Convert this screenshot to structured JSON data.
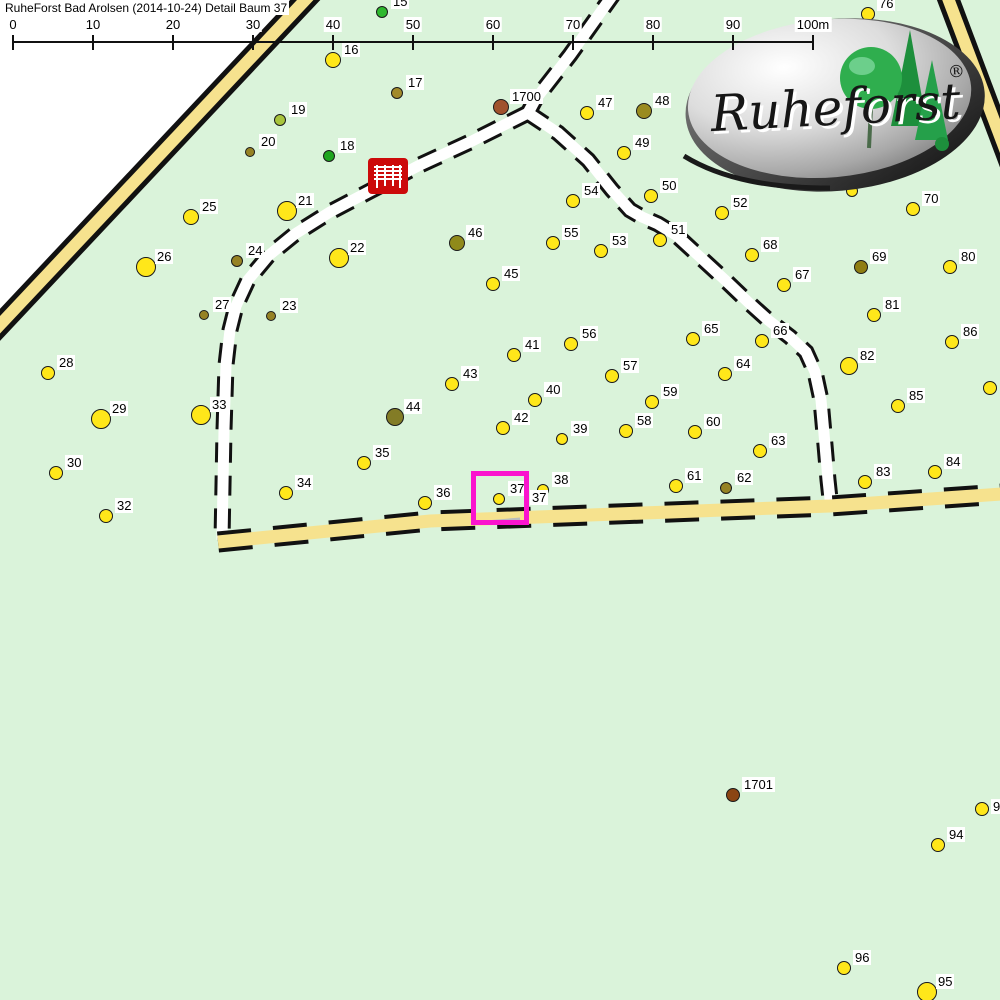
{
  "title": "RuheForst Bad Arolsen (2014-10-24) Detail  Baum 37",
  "logo": {
    "brand": "Ruheforst",
    "registered": "®"
  },
  "scale_bar": {
    "labels": [
      "0",
      "10",
      "20",
      "30",
      "40",
      "50",
      "60",
      "70",
      "80",
      "90",
      "100m"
    ],
    "x_start": 13,
    "x_spacing": 80,
    "line_y": 42,
    "tick_top": 35,
    "tick_bottom": 50
  },
  "map": {
    "background": "#daf3da",
    "outside_fill": "#ffffff",
    "outside_polygon": "0,0 310,0 0,335",
    "road_fill": "#f6e28e",
    "trail_fill": "#ffffff",
    "casing_color": "#111111",
    "highlight_color": "#fa14ce",
    "bench_color": "#cc0a0a",
    "roads": [
      {
        "name": "road-top-left",
        "edge": "solid",
        "pts": "324,-20 -19,345"
      },
      {
        "name": "road-top-right",
        "edge": "solid",
        "pts": "943,-15 1012,168"
      },
      {
        "name": "road-bottom",
        "edge": "dash",
        "pts": "218,542 430,521 830,506 1002,494"
      }
    ],
    "paths": [
      {
        "name": "trail-north",
        "pts": "615,-8 570,55 535,100 528,113"
      },
      {
        "name": "trail-west",
        "pts": "528,113 470,142 420,165 372,190 330,212 295,234 268,256 248,280 236,306 230,330 226,365 224,430 222,540"
      },
      {
        "name": "trail-east",
        "pts": "528,113 558,133 588,160 612,190 630,210 642,217 658,224 676,235 700,257 725,280 748,302 768,320 790,337 806,352 815,372 821,400 825,445 828,480 831,508"
      }
    ],
    "gray_line": {
      "x1": 486,
      "y1": 522,
      "x2": 520,
      "y2": 519,
      "color": "#b9bdbd"
    },
    "highlight_box": {
      "x": 471,
      "y": 471,
      "w": 58,
      "h": 54,
      "border": 5
    },
    "trees": [
      {
        "id": "15",
        "x": 382,
        "y": 12,
        "r": 6,
        "color": "#2eb82e"
      },
      {
        "id": "16",
        "x": 333,
        "y": 60,
        "r": 8,
        "color": "#ffe71a"
      },
      {
        "id": "17",
        "x": 397,
        "y": 93,
        "r": 6,
        "color": "#a28a2a"
      },
      {
        "id": "18",
        "x": 329,
        "y": 156,
        "r": 6,
        "color": "#1fa51f"
      },
      {
        "id": "19",
        "x": 280,
        "y": 120,
        "r": 6,
        "color": "#a8c43c"
      },
      {
        "id": "20",
        "x": 250,
        "y": 152,
        "r": 5,
        "color": "#968224"
      },
      {
        "id": "21",
        "x": 287,
        "y": 211,
        "r": 10,
        "color": "#ffe71a"
      },
      {
        "id": "22",
        "x": 339,
        "y": 258,
        "r": 10,
        "color": "#ffe71a"
      },
      {
        "id": "23",
        "x": 271,
        "y": 316,
        "r": 5,
        "color": "#968224"
      },
      {
        "id": "24",
        "x": 237,
        "y": 261,
        "r": 6,
        "color": "#968224"
      },
      {
        "id": "25",
        "x": 191,
        "y": 217,
        "r": 8,
        "color": "#ffe71a"
      },
      {
        "id": "26",
        "x": 146,
        "y": 267,
        "r": 10,
        "color": "#ffe71a"
      },
      {
        "id": "27",
        "x": 204,
        "y": 315,
        "r": 5,
        "color": "#968224"
      },
      {
        "id": "28",
        "x": 48,
        "y": 373,
        "r": 7,
        "color": "#ffe71a"
      },
      {
        "id": "29",
        "x": 101,
        "y": 419,
        "r": 10,
        "color": "#ffe71a"
      },
      {
        "id": "30",
        "x": 56,
        "y": 473,
        "r": 7,
        "color": "#ffe71a"
      },
      {
        "id": "32",
        "x": 106,
        "y": 516,
        "r": 7,
        "color": "#ffe71a"
      },
      {
        "id": "33",
        "x": 201,
        "y": 415,
        "r": 10,
        "color": "#ffe71a"
      },
      {
        "id": "34",
        "x": 286,
        "y": 493,
        "r": 7,
        "color": "#ffe71a"
      },
      {
        "id": "35",
        "x": 364,
        "y": 463,
        "r": 7,
        "color": "#ffe71a"
      },
      {
        "id": "36",
        "x": 425,
        "y": 503,
        "r": 7,
        "color": "#ffe71a"
      },
      {
        "id": "37",
        "x": 499,
        "y": 499,
        "r": 6,
        "color": "#ffe71a"
      },
      {
        "id": "38",
        "x": 543,
        "y": 490,
        "r": 6,
        "color": "#ffe71a"
      },
      {
        "id": "39",
        "x": 562,
        "y": 439,
        "r": 6,
        "color": "#ffe71a"
      },
      {
        "id": "40",
        "x": 535,
        "y": 400,
        "r": 7,
        "color": "#ffe71a"
      },
      {
        "id": "41",
        "x": 514,
        "y": 355,
        "r": 7,
        "color": "#ffe71a"
      },
      {
        "id": "42",
        "x": 503,
        "y": 428,
        "r": 7,
        "color": "#ffe71a"
      },
      {
        "id": "43",
        "x": 452,
        "y": 384,
        "r": 7,
        "color": "#ffe71a"
      },
      {
        "id": "44",
        "x": 395,
        "y": 417,
        "r": 9,
        "color": "#837c26"
      },
      {
        "id": "45",
        "x": 493,
        "y": 284,
        "r": 7,
        "color": "#ffe71a"
      },
      {
        "id": "46",
        "x": 457,
        "y": 243,
        "r": 8,
        "color": "#8f8a1a"
      },
      {
        "id": "47",
        "x": 587,
        "y": 113,
        "r": 7,
        "color": "#ffe71a"
      },
      {
        "id": "48",
        "x": 644,
        "y": 111,
        "r": 8,
        "color": "#9a8b1f"
      },
      {
        "id": "49",
        "x": 624,
        "y": 153,
        "r": 7,
        "color": "#ffe71a"
      },
      {
        "id": "50",
        "x": 651,
        "y": 196,
        "r": 7,
        "color": "#ffe71a"
      },
      {
        "id": "51",
        "x": 660,
        "y": 240,
        "r": 7,
        "color": "#ffe71a"
      },
      {
        "id": "52",
        "x": 722,
        "y": 213,
        "r": 7,
        "color": "#ffe71a"
      },
      {
        "id": "53",
        "x": 601,
        "y": 251,
        "r": 7,
        "color": "#ffe71a"
      },
      {
        "id": "54",
        "x": 573,
        "y": 201,
        "r": 7,
        "color": "#ffe71a"
      },
      {
        "id": "55",
        "x": 553,
        "y": 243,
        "r": 7,
        "color": "#ffe71a"
      },
      {
        "id": "56",
        "x": 571,
        "y": 344,
        "r": 7,
        "color": "#ffe71a"
      },
      {
        "id": "57",
        "x": 612,
        "y": 376,
        "r": 7,
        "color": "#ffe71a"
      },
      {
        "id": "58",
        "x": 626,
        "y": 431,
        "r": 7,
        "color": "#ffe71a"
      },
      {
        "id": "59",
        "x": 652,
        "y": 402,
        "r": 7,
        "color": "#ffe71a"
      },
      {
        "id": "60",
        "x": 695,
        "y": 432,
        "r": 7,
        "color": "#ffe71a"
      },
      {
        "id": "61",
        "x": 676,
        "y": 486,
        "r": 7,
        "color": "#ffe71a"
      },
      {
        "id": "62",
        "x": 726,
        "y": 488,
        "r": 6,
        "color": "#968224"
      },
      {
        "id": "63",
        "x": 760,
        "y": 451,
        "r": 7,
        "color": "#ffe71a"
      },
      {
        "id": "64",
        "x": 725,
        "y": 374,
        "r": 7,
        "color": "#ffe71a"
      },
      {
        "id": "65",
        "x": 693,
        "y": 339,
        "r": 7,
        "color": "#ffe71a"
      },
      {
        "id": "66",
        "x": 762,
        "y": 341,
        "r": 7,
        "color": "#ffe71a"
      },
      {
        "id": "67",
        "x": 784,
        "y": 285,
        "r": 7,
        "color": "#ffe71a"
      },
      {
        "id": "68",
        "x": 752,
        "y": 255,
        "r": 7,
        "color": "#ffe71a"
      },
      {
        "id": "69",
        "x": 861,
        "y": 267,
        "r": 7,
        "color": "#8f7d12"
      },
      {
        "id": "70",
        "x": 913,
        "y": 209,
        "r": 7,
        "color": "#ffe71a"
      },
      {
        "id": "76",
        "x": 868,
        "y": 14,
        "r": 7,
        "color": "#ffe71a"
      },
      {
        "id": "80",
        "x": 950,
        "y": 267,
        "r": 7,
        "color": "#ffe71a"
      },
      {
        "id": "81",
        "x": 874,
        "y": 315,
        "r": 7,
        "color": "#ffe71a"
      },
      {
        "id": "82",
        "x": 849,
        "y": 366,
        "r": 9,
        "color": "#ffe71a"
      },
      {
        "id": "83",
        "x": 865,
        "y": 482,
        "r": 7,
        "color": "#ffe71a"
      },
      {
        "id": "84",
        "x": 935,
        "y": 472,
        "r": 7,
        "color": "#ffe71a"
      },
      {
        "id": "85",
        "x": 898,
        "y": 406,
        "r": 7,
        "color": "#ffe71a"
      },
      {
        "id": "86",
        "x": 952,
        "y": 342,
        "r": 7,
        "color": "#ffe71a"
      },
      {
        "id": "94",
        "x": 938,
        "y": 845,
        "r": 7,
        "color": "#ffe71a"
      },
      {
        "id": "95",
        "x": 927,
        "y": 992,
        "r": 10,
        "color": "#ffe71a"
      },
      {
        "id": "96",
        "x": 844,
        "y": 968,
        "r": 7,
        "color": "#ffe71a"
      },
      {
        "id": "1700",
        "x": 501,
        "y": 107,
        "r": 8,
        "color": "#a0522d"
      },
      {
        "id": "1701",
        "x": 733,
        "y": 795,
        "r": 7,
        "color": "#8b4513"
      },
      {
        "id": "",
        "x": 990,
        "y": 388,
        "r": 7,
        "color": "#ffe71a"
      },
      {
        "id": "",
        "x": 982,
        "y": 809,
        "r": 7,
        "color": "#ffe71a"
      },
      {
        "id": "",
        "x": 852,
        "y": 191,
        "r": 6,
        "color": "#ffe71a"
      }
    ],
    "extra_labels": [
      {
        "text": "37",
        "x": 530,
        "y": 490
      },
      {
        "text": "9",
        "x": 991,
        "y": 799
      }
    ]
  }
}
